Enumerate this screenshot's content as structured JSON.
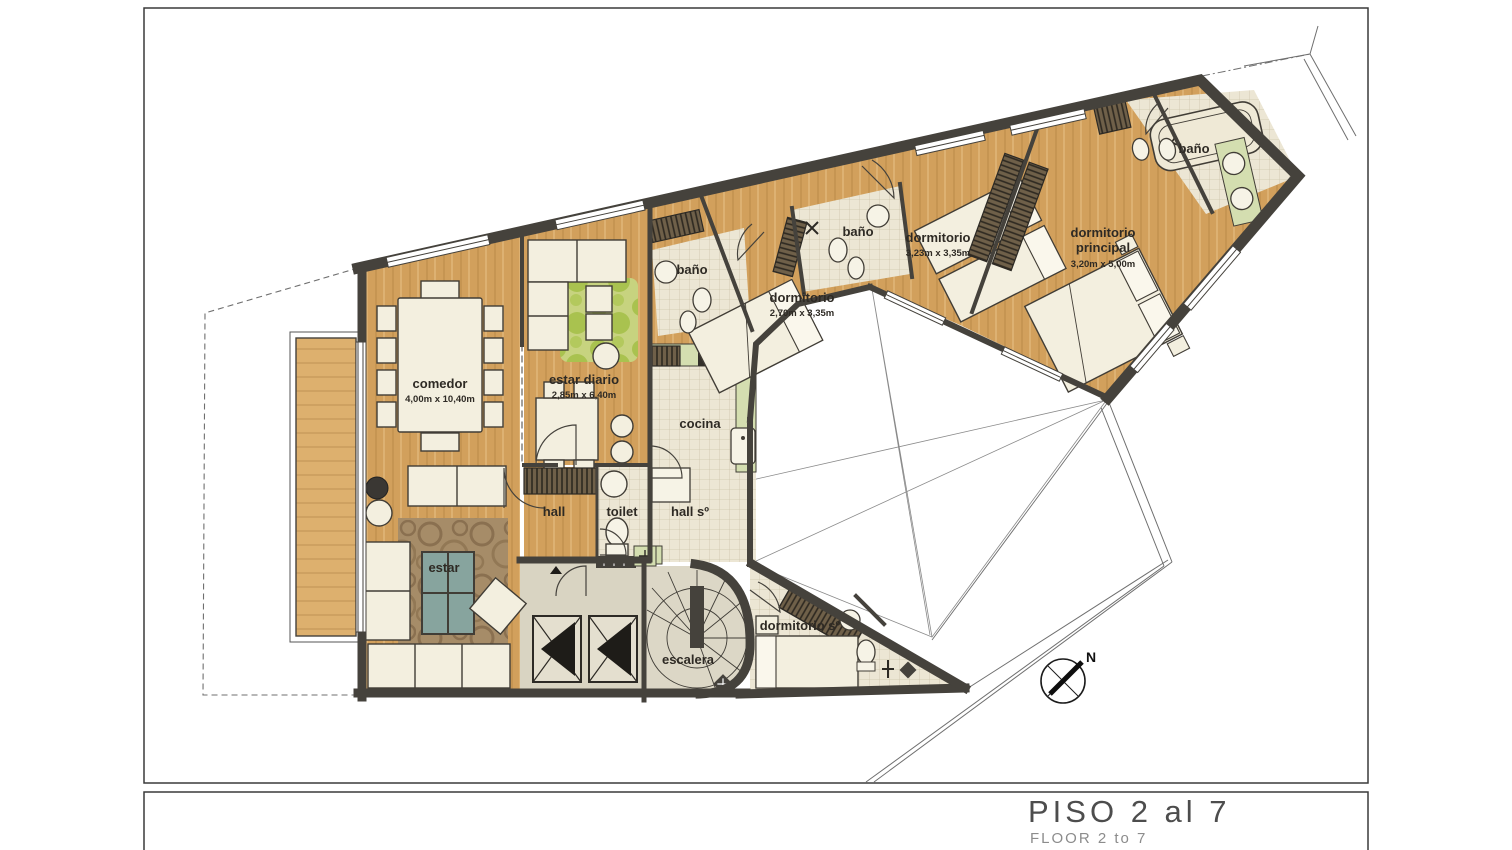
{
  "title_block": {
    "title": "PISO 2 al 7",
    "subtitle": "FLOOR 2 to 7"
  },
  "compass": {
    "label": "N"
  },
  "rooms": {
    "comedor": {
      "label": "comedor",
      "dims": "4,00m x 10,40m"
    },
    "estar_diario": {
      "label": "estar diario",
      "dims": "2,85m x 6,40m"
    },
    "estar": {
      "label": "estar"
    },
    "hall": {
      "label": "hall"
    },
    "toilet": {
      "label": "toilet"
    },
    "cocina": {
      "label": "cocina"
    },
    "hall_servicio": {
      "label": "hall sº"
    },
    "escalera": {
      "label": "escalera"
    },
    "dormitorio_servicio": {
      "label": "dormitorio sº"
    },
    "bano_1": {
      "label": "baño"
    },
    "bano_2": {
      "label": "baño"
    },
    "bano_principal": {
      "label": "baño"
    },
    "dormitorio_1": {
      "label": "dormitorio",
      "dims": "2,70m x 3,35m"
    },
    "dormitorio_2": {
      "label": "dormitorio",
      "dims": "3,23m x 3,35m"
    },
    "dormitorio_principal": {
      "label_line1": "dormitorio",
      "label_line2": "principal",
      "dims": "3,20m x 5,00m"
    }
  },
  "colors": {
    "wall": "#45423c",
    "wood": "#d2a05c",
    "balcony_wood": "#ddb06e",
    "tile": "#ece6d4",
    "green": "#d4deb0",
    "lobby": "#d9d4c2",
    "furniture": "#f3efdf",
    "rug": "#a68c68",
    "glass": "#87a49e",
    "green_rug": "#c7d37f"
  }
}
